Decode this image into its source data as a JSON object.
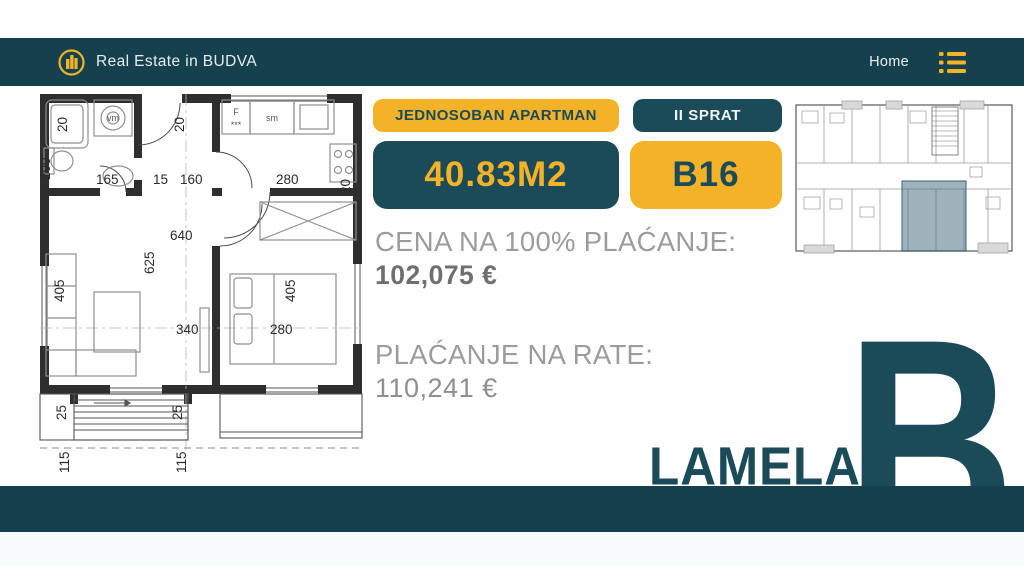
{
  "header": {
    "brand": "Real Estate in BUDVA",
    "nav_home": "Home"
  },
  "badges": {
    "type_label": "JEDNOSOBAN APARTMAN",
    "floor_label": "II SPRAT",
    "area_label": "40.83M2",
    "unit_label": "B16"
  },
  "pricing": {
    "full_payment_label": "CENA NA 100% PLAĆANJE:",
    "full_payment_value": "102,075 €",
    "installment_label": "PLAĆANJE NA RATE:",
    "installment_value": "110,241 €"
  },
  "building": {
    "lamela_label": "LAMELA",
    "lamela_letter": "B"
  },
  "colors": {
    "teal_dark": "#15414F",
    "teal_badge": "#1B4A58",
    "yellow": "#F3B227",
    "thumb_highlight": "rgba(61,103,120,0.5)"
  },
  "icons": {
    "logo": "buildings-logo-icon",
    "menu": "menu-list-icon"
  },
  "floor_plan": {
    "dimension_labels": [
      {
        "text": "20",
        "x": 33,
        "y": 44,
        "rot": -90
      },
      {
        "text": "20",
        "x": 150,
        "y": 44,
        "rot": -90
      },
      {
        "text": "200",
        "x": 16,
        "y": 92,
        "rot": -90
      },
      {
        "text": "165",
        "x": 62,
        "y": 96
      },
      {
        "text": "15",
        "x": 119,
        "y": 96
      },
      {
        "text": "160",
        "x": 146,
        "y": 96
      },
      {
        "text": "280",
        "x": 242,
        "y": 96
      },
      {
        "text": "20",
        "x": 316,
        "y": 106,
        "rot": -90
      },
      {
        "text": "640",
        "x": 136,
        "y": 152
      },
      {
        "text": "625",
        "x": 120,
        "y": 186,
        "rot": -90
      },
      {
        "text": "405",
        "x": 30,
        "y": 214,
        "rot": -90
      },
      {
        "text": "340",
        "x": 142,
        "y": 246
      },
      {
        "text": "280",
        "x": 236,
        "y": 246
      },
      {
        "text": "405",
        "x": 261,
        "y": 214,
        "rot": -90
      },
      {
        "text": "25",
        "x": 32,
        "y": 332,
        "rot": -90
      },
      {
        "text": "25",
        "x": 148,
        "y": 332,
        "rot": -90
      },
      {
        "text": "115",
        "x": 35,
        "y": 385,
        "rot": -90
      },
      {
        "text": "115",
        "x": 152,
        "y": 385,
        "rot": -90
      }
    ],
    "fixture_labels": [
      {
        "text": "vm",
        "x": 79,
        "y": 33
      },
      {
        "text": "F",
        "x": 202,
        "y": 27
      },
      {
        "text": "***",
        "x": 202,
        "y": 40
      },
      {
        "text": "sm",
        "x": 238,
        "y": 33
      }
    ]
  }
}
